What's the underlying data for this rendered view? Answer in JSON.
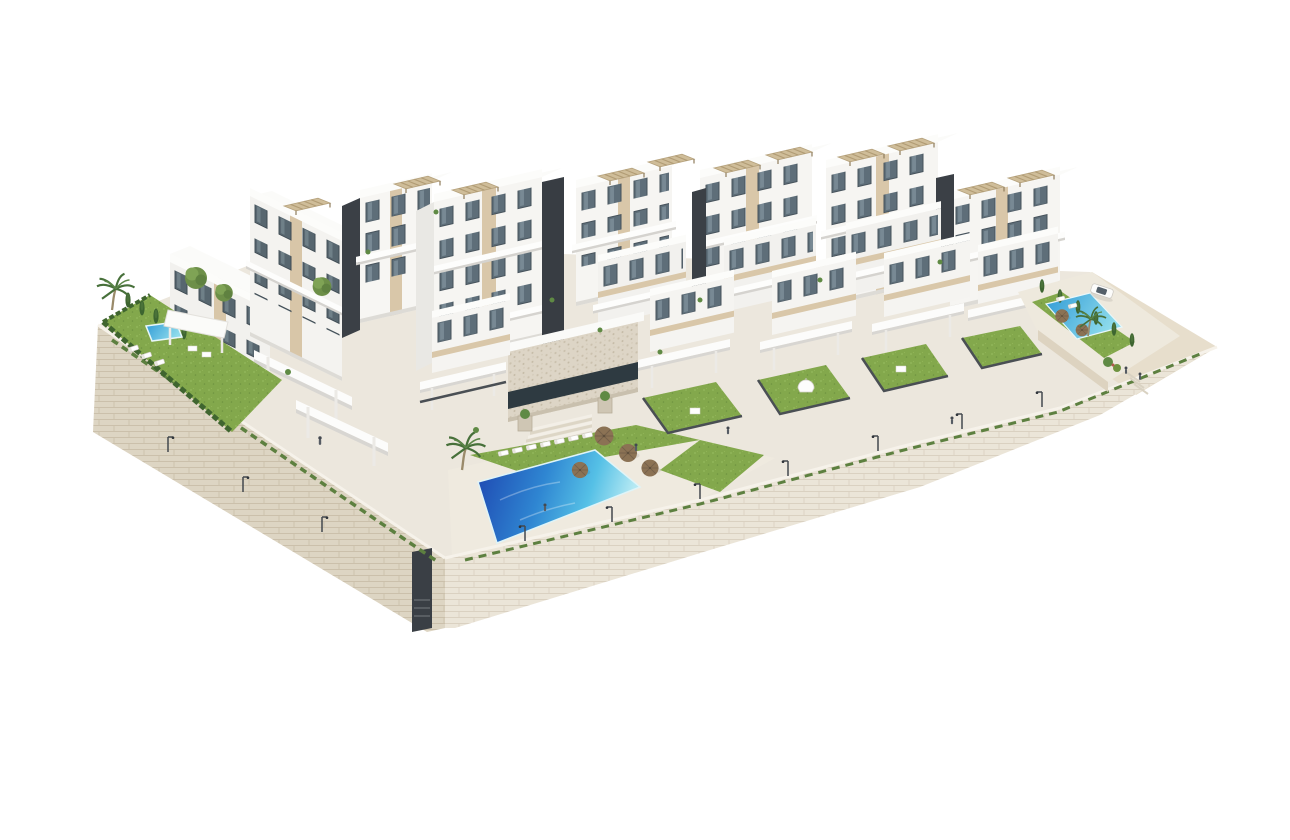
{
  "scene": {
    "kind": "architectural-3d-render",
    "subject": "aerial dimetric rendering of a white hillside apartment complex with terraced buildings, gardens and swimming pools on a stone retaining wall",
    "background_color": "#ffffff"
  },
  "palette": {
    "background": "#ffffff",
    "building_white": "#f6f5f2",
    "building_shadow_face": "#e9e8e4",
    "roof_white": "#fbfbf9",
    "parapet_shadow": "#d8d6d2",
    "facade_beige": "#d9c7a9",
    "dark_core": "#3b4046",
    "window_glass": "#5e6e79",
    "window_frame": "#46525b",
    "stone_wall": "#e6decd",
    "stone_joint": "#d0c5b0",
    "paving": "#ece7dd",
    "bank_soil": "#e7decc",
    "grass": "#83a84c",
    "grass_light": "#95ba5e",
    "hedge_dark": "#3f652f",
    "pool_deep_blue": "#1d45b0",
    "pool_mid_blue": "#2f86d2",
    "pool_light_blue": "#55c0e6",
    "pool_pale": "#b5e9f3",
    "pergola_beige": "#cfbd99",
    "umbrella_brown": "#8b7254",
    "fence_dark": "#4a4f54",
    "car_white": "#fcfcfb"
  },
  "inventory": {
    "apartment_blocks": 7,
    "mid_row_villas": 3,
    "front_villas": 5,
    "rooftop_pergolas": 11,
    "swimming_pools": [
      {
        "name": "main-pool",
        "shape": "trapezoid",
        "position": "front-center"
      },
      {
        "name": "left-garden-pool",
        "shape": "rectangle",
        "position": "left-garden"
      },
      {
        "name": "right-garden-pool",
        "shape": "rectangle",
        "position": "right-garden"
      }
    ],
    "lawns": 7,
    "palm_trees": 3,
    "cypress_trees": 11,
    "round_trees": 3,
    "sun_umbrellas": 6,
    "sun_loungers": 14,
    "street_lamps": 10,
    "parked_cars": 1,
    "people": 6,
    "retaining_wall": true,
    "wall_stairwells": 1,
    "staircases": 2,
    "clubhouse_with_stone_facade": 1
  }
}
